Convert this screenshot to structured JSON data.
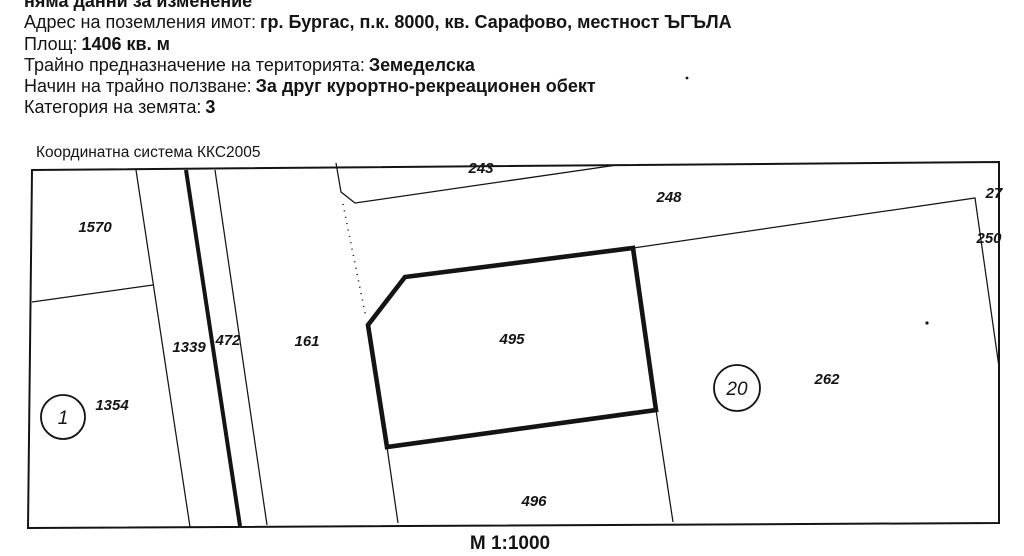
{
  "document": {
    "note_line": "няма данни за изменение",
    "fields": [
      {
        "label": "Адрес на поземления имот:",
        "value": "гр. Бургас, п.к. 8000, кв. Сарафово, местност ЪГЪЛА"
      },
      {
        "label": "Площ:",
        "value": "1406 кв. м"
      },
      {
        "label": "Трайно предназначение на територията:",
        "value": "Земеделска"
      },
      {
        "label": "Начин на трайно ползване:",
        "value": "За друг курортно-рекреационен обект"
      },
      {
        "label": "Категория на земята:",
        "value": "3"
      }
    ]
  },
  "map": {
    "coordinate_system_label": "Координатна система ККС2005",
    "scale_label": "М 1:1000",
    "subject_parcel_id": "495",
    "parcels": [
      {
        "id": "1570"
      },
      {
        "id": "1339"
      },
      {
        "id": "472"
      },
      {
        "id": "161"
      },
      {
        "id": "1354"
      },
      {
        "id": "243"
      },
      {
        "id": "248"
      },
      {
        "id": "27"
      },
      {
        "id": "250"
      },
      {
        "id": "495"
      },
      {
        "id": "496"
      },
      {
        "id": "262"
      }
    ],
    "circled_markers": [
      {
        "number": "1"
      },
      {
        "number": "20"
      }
    ],
    "colors": {
      "ink": "#141414",
      "paper": "#ffffff"
    }
  }
}
